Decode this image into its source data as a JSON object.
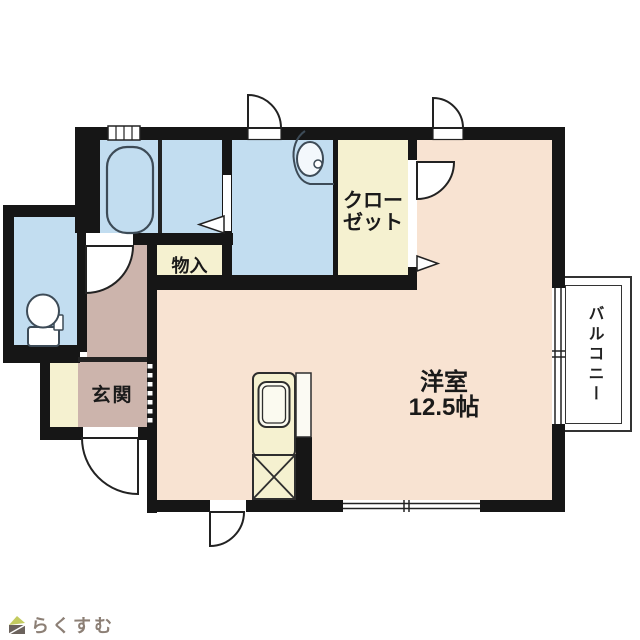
{
  "page": {
    "type": "apartment-floorplan"
  },
  "rooms": {
    "main_room": {
      "line1": "洋室",
      "line2": "12.5帖"
    },
    "closet": {
      "line1": "クロー",
      "line2": "ゼット"
    },
    "storage": {
      "label": "物入"
    },
    "entrance": {
      "label": "玄関"
    },
    "balcony": {
      "label": "バルコニー"
    }
  },
  "watermark": {
    "text": "らくすむ"
  },
  "colors": {
    "wall": "#161616",
    "western_room_pink": "#f8e3d2",
    "wet_area_blue": "#c2ddf0",
    "storage_cream": "#f5f1d0",
    "entrance_mauve": "#ccb4ac",
    "balcony_border": "#333333",
    "watermark_text": "#8c7f75",
    "watermark_logo_green": "#c3cb5f",
    "watermark_logo_dark": "#6b625c"
  }
}
